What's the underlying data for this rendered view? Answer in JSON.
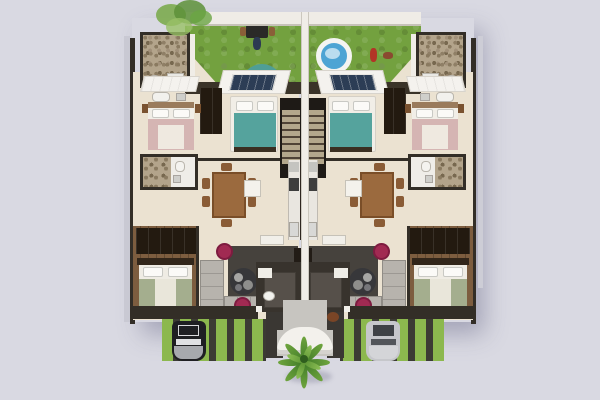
{
  "scene": {
    "description": "Top-down 3D architectural render of a mirrored two-unit duplex floor plan on a lavender background",
    "view": "top-down 3D floor plan",
    "units": [
      {
        "id": "left-unit",
        "features": [
          "backyard-lawn",
          "bbq-grill-with-person",
          "teal-patio-umbrella",
          "stone-walled-bathroom",
          "teal-bedroom",
          "pink-bedroom",
          "second-bathroom",
          "dining-table-six-chairs",
          "galley-kitchen",
          "living-room-gray-sectional",
          "two-magenta-poufs",
          "master-bedroom-sage-bed",
          "dark-porch",
          "green-striped-driveway",
          "dark-parked-car"
        ]
      },
      {
        "id": "right-unit",
        "features": [
          "backyard-lawn",
          "round-swimming-pool",
          "two-yard-figures",
          "stone-walled-bathroom",
          "teal-bedroom",
          "pink-bedroom",
          "second-bathroom",
          "dining-table-six-chairs",
          "galley-kitchen",
          "living-room-gray-sectional",
          "two-magenta-poufs",
          "master-bedroom-sage-bed",
          "dark-porch",
          "green-striped-driveway",
          "silver-parked-car"
        ]
      }
    ],
    "shared_elements": [
      "central-twin-staircases",
      "white-party-wall",
      "entry-walkway",
      "white-entry-arch",
      "palm-tree",
      "white-dog",
      "brown-dog",
      "garden-tree-top-left",
      "rooftop-solar-panels"
    ]
  },
  "palette": {
    "background": "#d9d9e2",
    "wall_dark": "#332e27",
    "wall_white": "#f0ede7",
    "floor": "#ebe2d1",
    "lawn": "#73a13f",
    "lawn_edge": "#3a3328",
    "stripe_green": "#8cb84e",
    "stripe_dark": "#3c3b34",
    "stone": "#b3a48b",
    "stone_speckle": "#8a7a60",
    "teal": "#55a39d",
    "umbrella_teal": "#4f9e96",
    "pool_blue": "#4da4d4",
    "pink": "#d5b5b3",
    "magenta": "#a12a52",
    "sofa_gray": "#b7b3ad",
    "rug_dark": "#46423d",
    "wood": "#7d5d3f",
    "wardrobe_dark": "#231a10",
    "walkway_gray": "#c7c5c0",
    "palm_green": "#6fa53e",
    "car_dark": "#1f1f23",
    "car_silver": "#c6c7cb",
    "roof_white": "#f4f2ee",
    "solar_navy": "#2c3d55",
    "table_brown": "#9b6a3e"
  }
}
